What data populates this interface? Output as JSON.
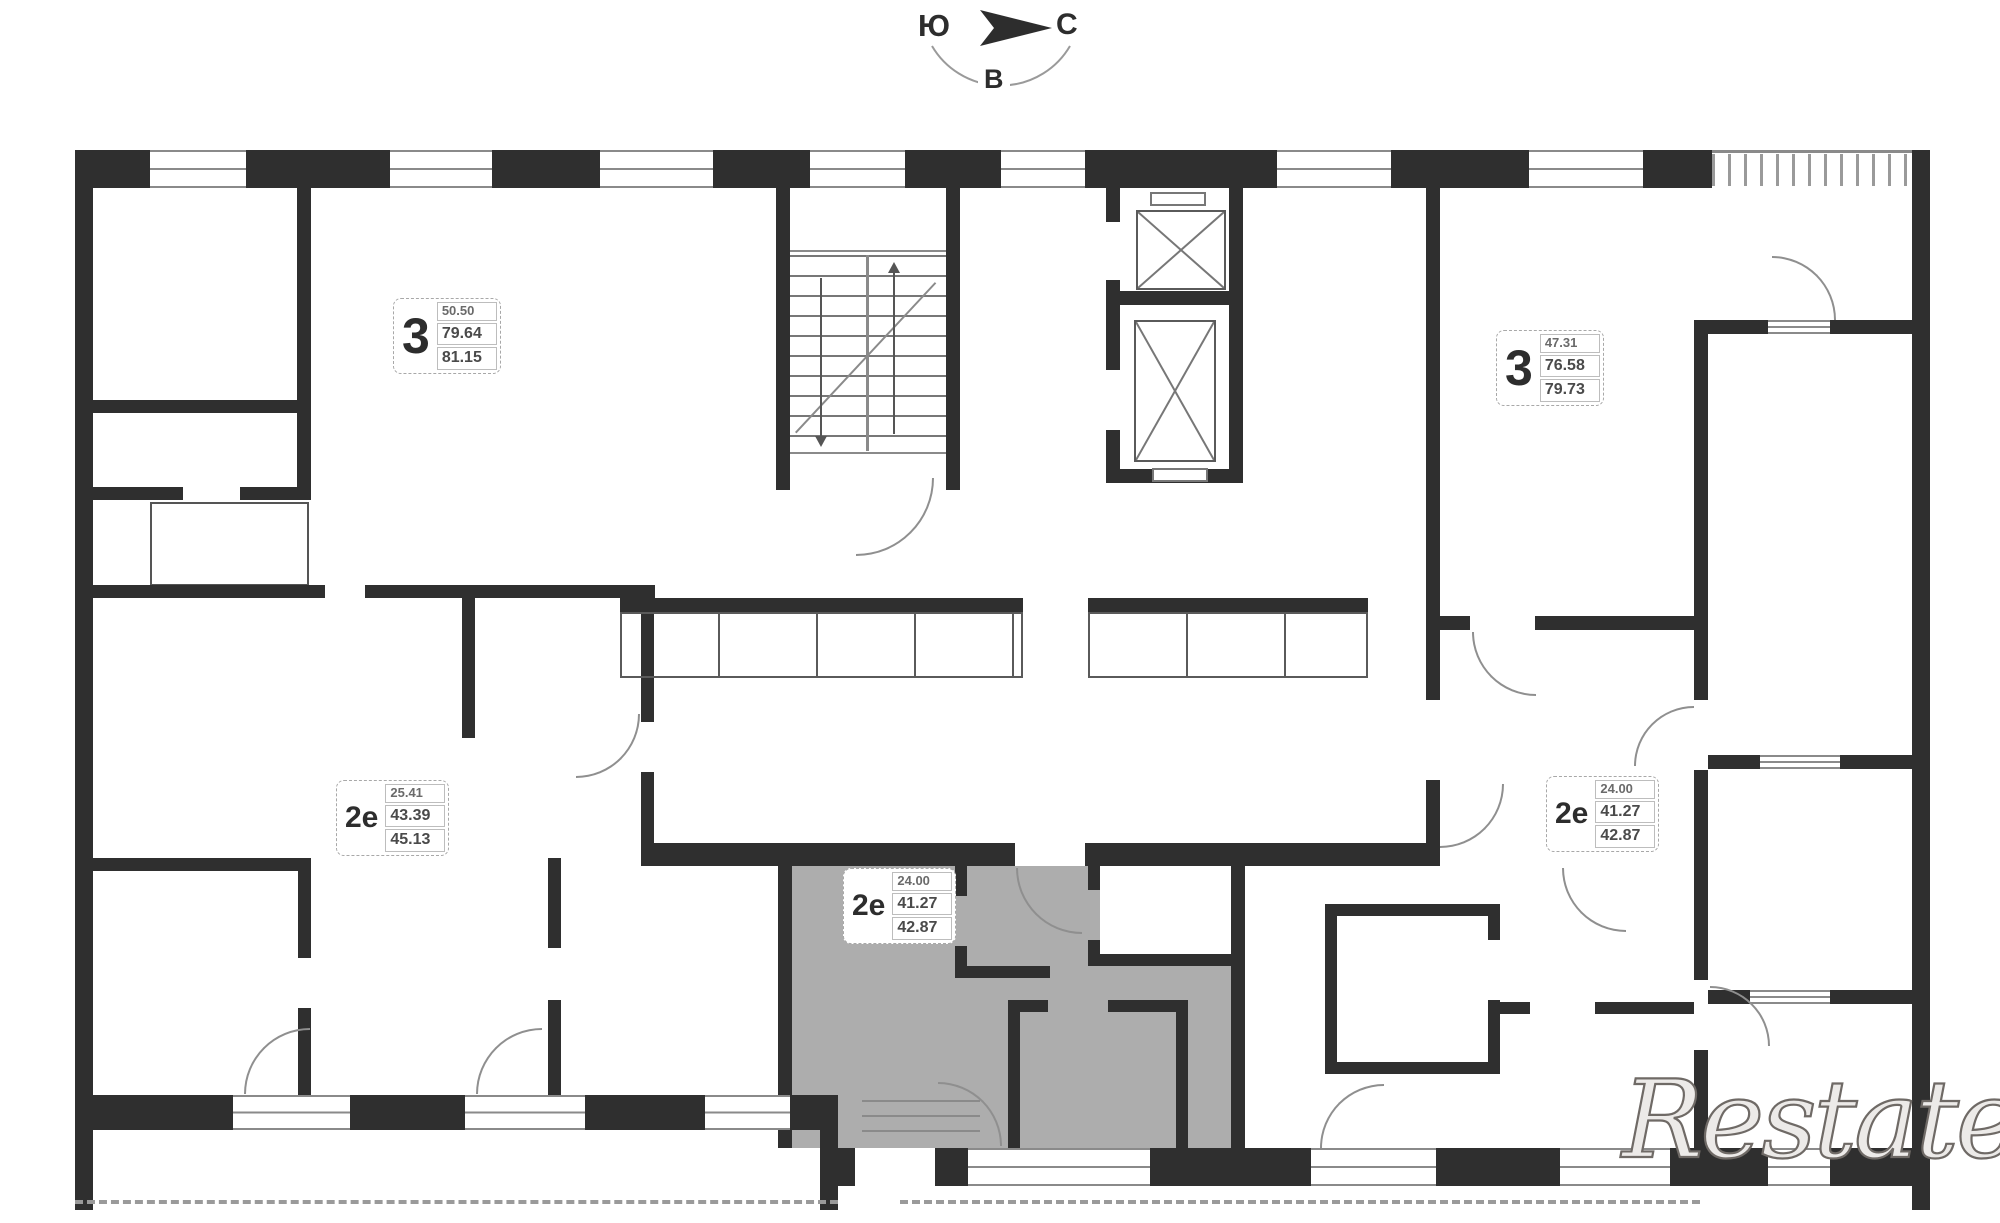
{
  "title": "Floor plan",
  "compass": {
    "south": "Ю",
    "north": "С",
    "east": "В"
  },
  "watermark": "Restate",
  "colors": {
    "wall": "#2f2f2f",
    "line": "#8a8a8a",
    "highlight": "#adadad",
    "background": "#ffffff"
  },
  "apartments": [
    {
      "id": "apt-3-top-left",
      "type": "3",
      "area_top": "50.50",
      "area_mid": "79.64",
      "area_total": "81.15",
      "highlighted": false
    },
    {
      "id": "apt-3-top-right",
      "type": "3",
      "area_top": "47.31",
      "area_mid": "76.58",
      "area_total": "79.73",
      "highlighted": false
    },
    {
      "id": "apt-2e-left",
      "type": "2е",
      "area_top": "25.41",
      "area_mid": "43.39",
      "area_total": "45.13",
      "highlighted": false
    },
    {
      "id": "apt-2e-center",
      "type": "2е",
      "area_top": "24.00",
      "area_mid": "41.27",
      "area_total": "42.87",
      "highlighted": true
    },
    {
      "id": "apt-2e-right",
      "type": "2е",
      "area_top": "24.00",
      "area_mid": "41.27",
      "area_total": "42.87",
      "highlighted": false
    }
  ]
}
